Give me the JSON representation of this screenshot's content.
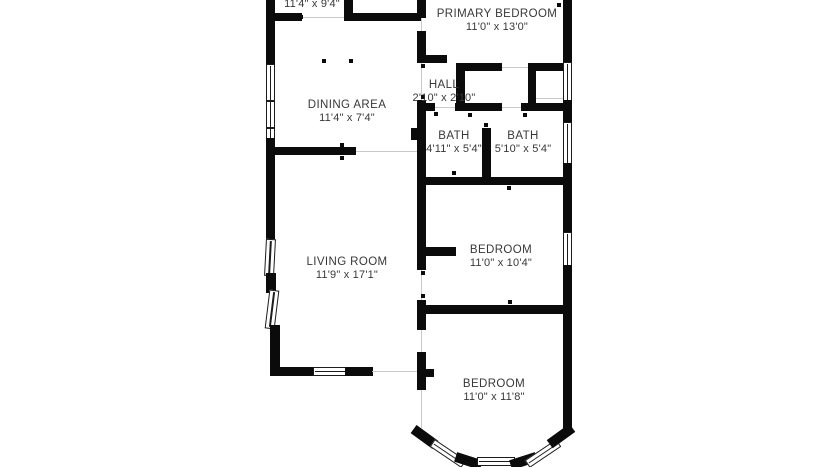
{
  "colors": {
    "wall": "#0b0b0b",
    "text": "#383838",
    "window_frame": "#1c1c1c",
    "opening_line": "#c9c9c9",
    "background": "#ffffff"
  },
  "rooms": [
    {
      "id": "top-room",
      "name": "",
      "dims": "11'4\" x 9'4\""
    },
    {
      "id": "primary-bedroom",
      "name": "PRIMARY BEDROOM",
      "dims": "11'0\" x 13'0\""
    },
    {
      "id": "hall",
      "name": "HALL",
      "dims": "2'10\" x 2'10\""
    },
    {
      "id": "dining-area",
      "name": "DINING AREA",
      "dims": "11'4\" x 7'4\""
    },
    {
      "id": "bath-left",
      "name": "BATH",
      "dims": "4'11\" x 5'4\""
    },
    {
      "id": "bath-right",
      "name": "BATH",
      "dims": "5'10\" x 5'4\""
    },
    {
      "id": "living-room",
      "name": "LIVING ROOM",
      "dims": "11'9\" x 17'1\""
    },
    {
      "id": "bedroom-middle",
      "name": "BEDROOM",
      "dims": "11'0\" x 10'4\""
    },
    {
      "id": "bedroom-bottom",
      "name": "BEDROOM",
      "dims": "11'0\" x 11'8\""
    }
  ]
}
